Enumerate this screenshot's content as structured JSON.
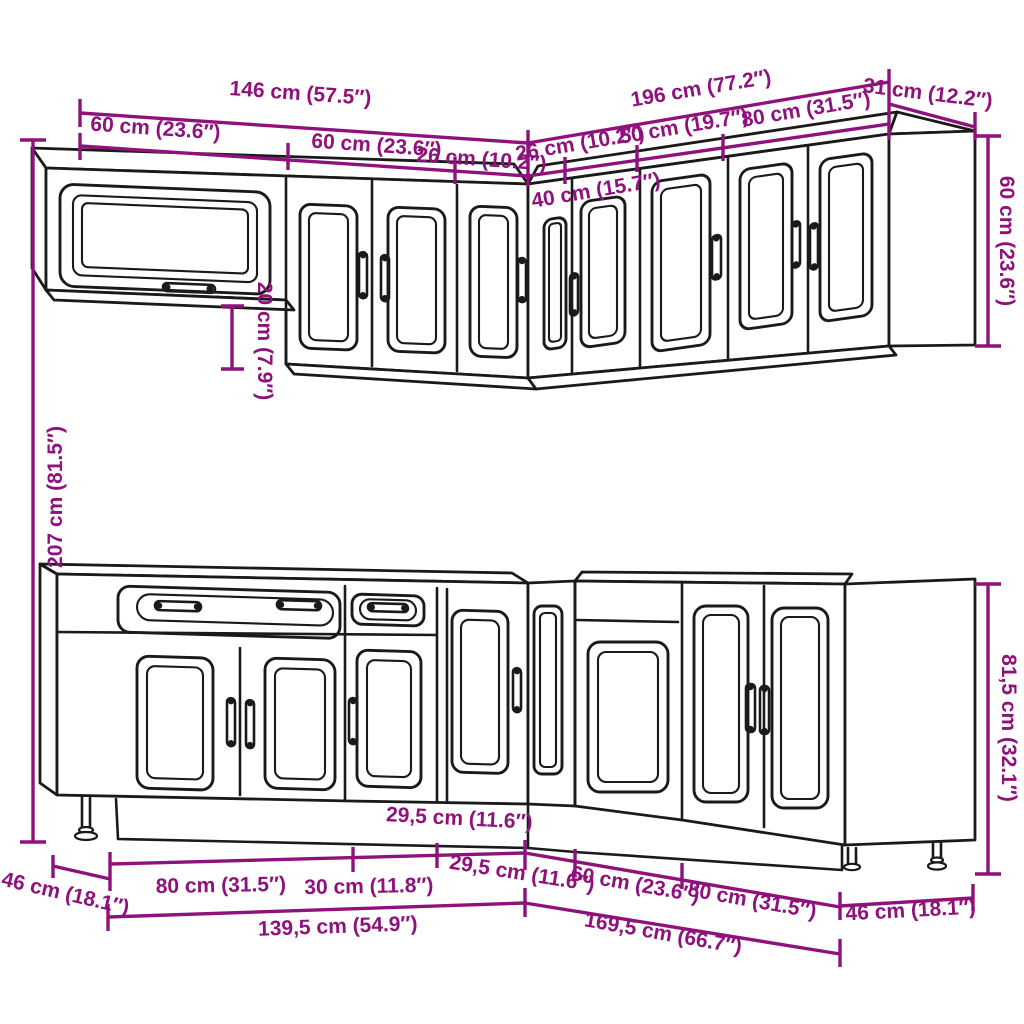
{
  "colors": {
    "dimension_magenta": "#8F127C",
    "linework_black": "#1A1A1A",
    "background": "#FFFFFF"
  },
  "labels": {
    "top_total_left": "146 cm (57.5″)",
    "top_total_right": "196 cm (77.2″)",
    "top_depth_right": "31 cm (12.2″)",
    "top_seg_glass": "60 cm (23.6″)",
    "top_seg_double": "60 cm (23.6″)",
    "top_seg_26_left": "26 cm (10.2″)",
    "top_seg_26_right": "26 cm (10.2″)",
    "top_seg_50": "50 cm (19.7″)",
    "top_seg_80": "80 cm (31.5″)",
    "top_seg_40_corner": "40 cm (15.7″)",
    "top_drop": "20 cm (7.9″)",
    "total_height": "207 cm (81.5″)",
    "wall_height": "60 cm (23.6″)",
    "base_height": "81,5 cm (32.1″)",
    "base_depth_left": "46 cm (18.1″)",
    "base_seg_80_left": "80 cm (31.5″)",
    "base_seg_30": "30 cm (11.8″)",
    "base_seg_295_left": "29,5 cm (11.6″)",
    "base_seg_295_right": "29,5 cm (11.6″)",
    "base_seg_60": "60 cm (23.6″)",
    "base_seg_80_right": "80 cm (31.5″)",
    "base_total_left": "139,5 cm (54.9″)",
    "base_total_right": "169,5 cm (66.7″)",
    "base_depth_right": "46 cm (18.1″)"
  }
}
